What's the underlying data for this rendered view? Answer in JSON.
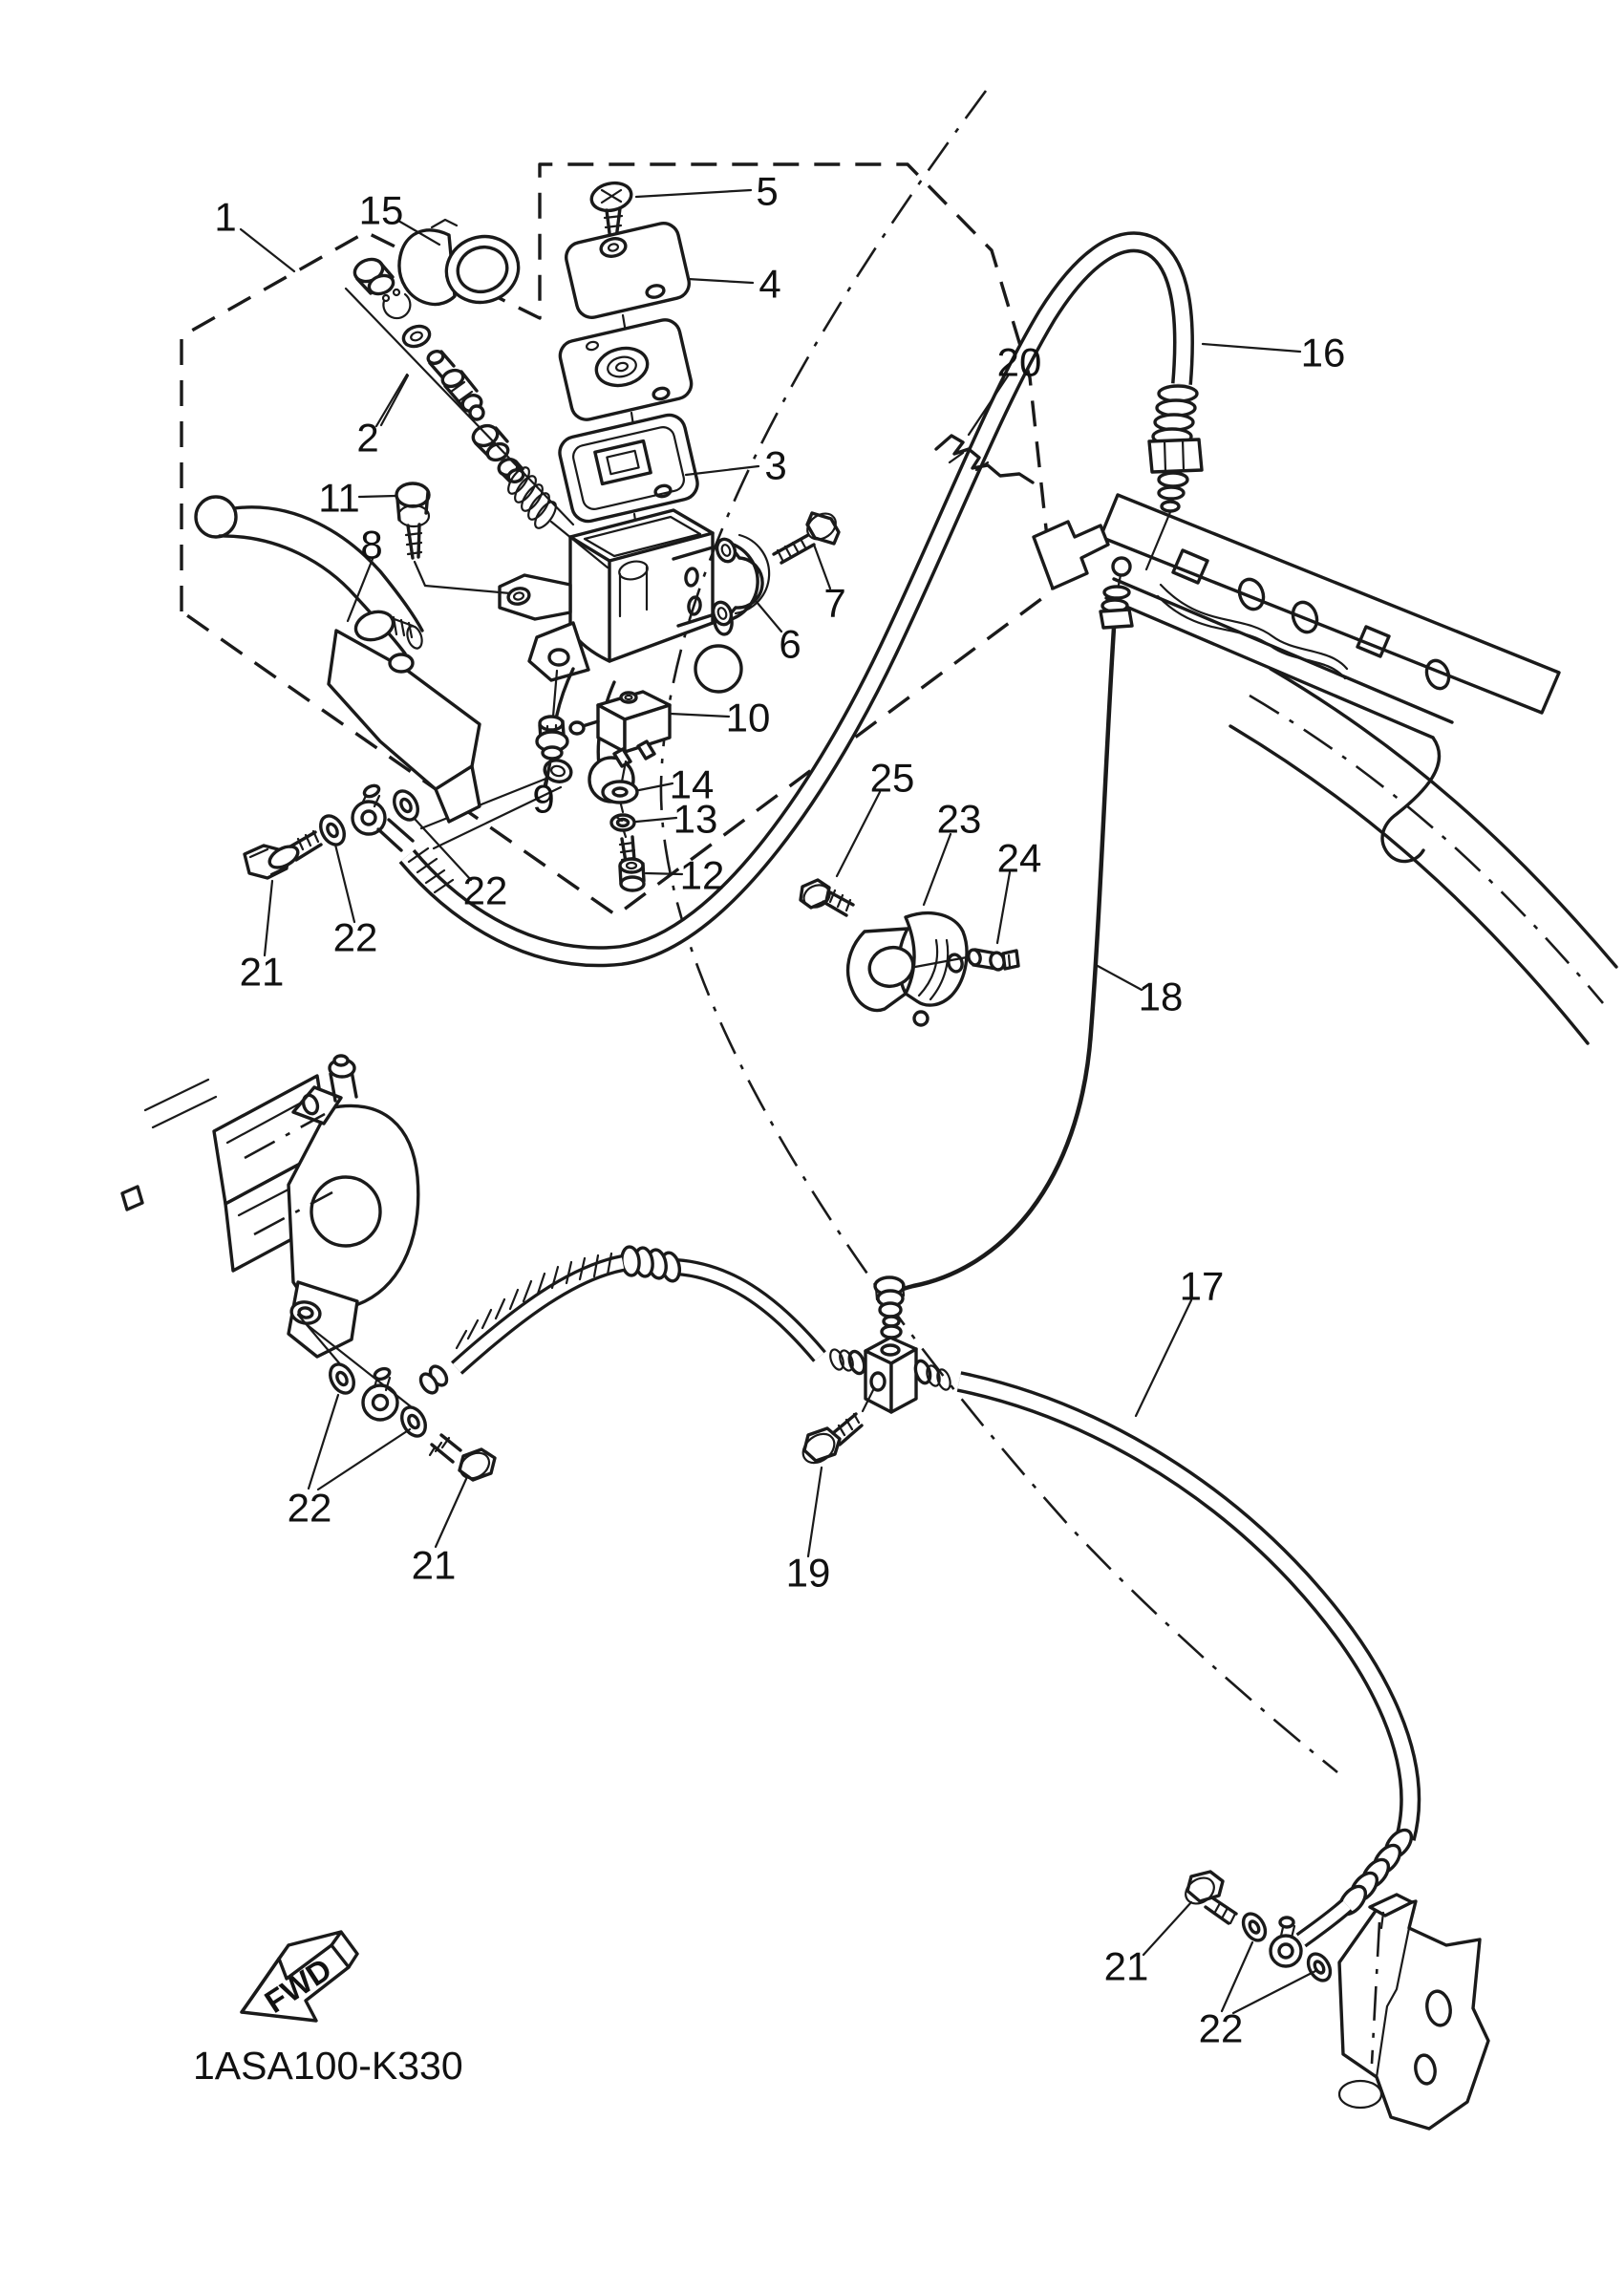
{
  "diagram": {
    "code": "1ASA100-K330",
    "fwd_label": "FWD",
    "line_color": "#1a1a1a",
    "background_color": "#ffffff",
    "callouts": [
      {
        "n": "1"
      },
      {
        "n": "15"
      },
      {
        "n": "5"
      },
      {
        "n": "4"
      },
      {
        "n": "2"
      },
      {
        "n": "3"
      },
      {
        "n": "11"
      },
      {
        "n": "8"
      },
      {
        "n": "7"
      },
      {
        "n": "6"
      },
      {
        "n": "10"
      },
      {
        "n": "9"
      },
      {
        "n": "14"
      },
      {
        "n": "13"
      },
      {
        "n": "12"
      },
      {
        "n": "22"
      },
      {
        "n": "22"
      },
      {
        "n": "21"
      },
      {
        "n": "16"
      },
      {
        "n": "20"
      },
      {
        "n": "25"
      },
      {
        "n": "23"
      },
      {
        "n": "24"
      },
      {
        "n": "18"
      },
      {
        "n": "17"
      },
      {
        "n": "19"
      },
      {
        "n": "21"
      },
      {
        "n": "22"
      },
      {
        "n": "21"
      },
      {
        "n": "22"
      }
    ]
  }
}
